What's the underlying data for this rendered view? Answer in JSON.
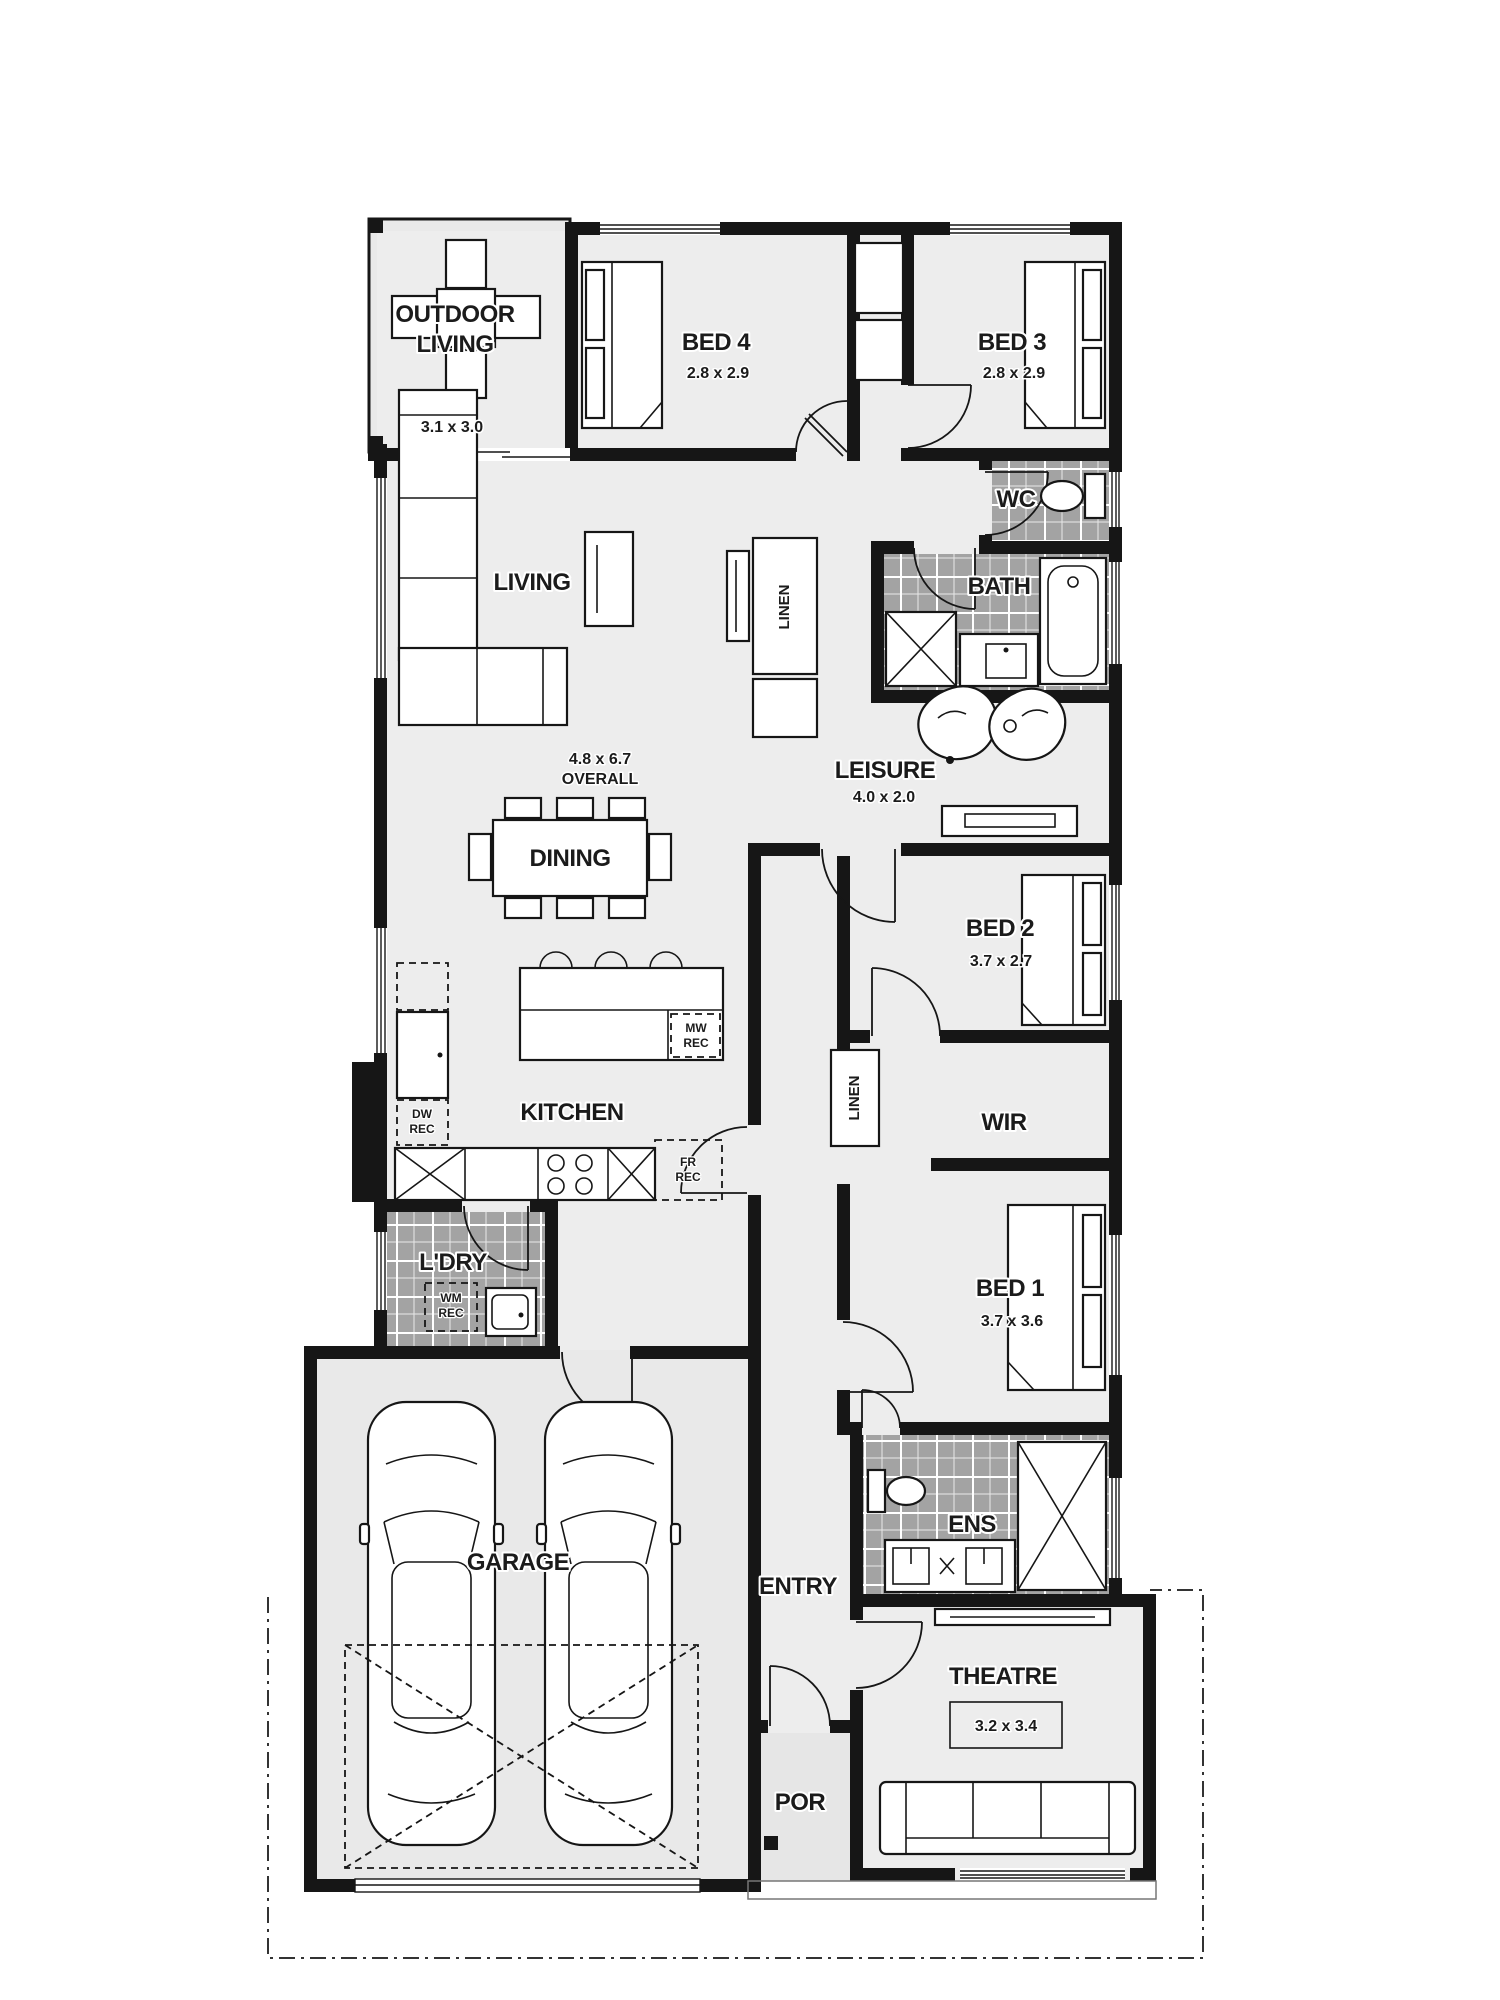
{
  "plan": {
    "type": "floor-plan",
    "rooms": [
      {
        "key": "outdoor-living",
        "name": "OUTDOOR",
        "name2": "LIVING",
        "dims": "3.1 x 3.0"
      },
      {
        "key": "bed4",
        "name": "BED 4",
        "dims": "2.8 x 2.9"
      },
      {
        "key": "bed3",
        "name": "BED 3",
        "dims": "2.8 x 2.9"
      },
      {
        "key": "wc",
        "name": "WC"
      },
      {
        "key": "bath",
        "name": "BATH"
      },
      {
        "key": "living",
        "name": "LIVING"
      },
      {
        "key": "linen-hall",
        "name": "LINEN"
      },
      {
        "key": "leisure",
        "name": "LEISURE",
        "dims": "4.0 x 2.0"
      },
      {
        "key": "dining",
        "name": "DINING"
      },
      {
        "key": "bed2",
        "name": "BED 2",
        "dims": "3.7 x 2.7"
      },
      {
        "key": "kitchen",
        "name": "KITCHEN"
      },
      {
        "key": "linen-lower",
        "name": "LINEN"
      },
      {
        "key": "wir",
        "name": "WIR"
      },
      {
        "key": "ldry",
        "name": "L'DRY"
      },
      {
        "key": "bed1",
        "name": "BED 1",
        "dims": "3.7 x 3.6"
      },
      {
        "key": "ens",
        "name": "ENS"
      },
      {
        "key": "entry",
        "name": "ENTRY"
      },
      {
        "key": "theatre",
        "name": "THEATRE",
        "dims": "3.2 x 3.4"
      },
      {
        "key": "garage",
        "name": "GARAGE"
      },
      {
        "key": "porch",
        "name": "POR"
      }
    ],
    "annotations": {
      "overall": {
        "line1": "4.8 x 6.7",
        "line2": "OVERALL"
      }
    },
    "recesses": [
      {
        "key": "microwave-recess",
        "code": "MW",
        "word": "REC"
      },
      {
        "key": "dishwasher-recess",
        "code": "DW",
        "word": "REC"
      },
      {
        "key": "fridge-recess",
        "code": "FR",
        "word": "REC"
      },
      {
        "key": "washing-machine-recess",
        "code": "WM",
        "word": "REC"
      }
    ],
    "colors": {
      "wall": "#161616",
      "floor": "#ededed",
      "outdoor_floor": "#e9e9e9",
      "tile": "#a3a3a3",
      "grout": "#ffffff",
      "background": "#ffffff"
    }
  }
}
